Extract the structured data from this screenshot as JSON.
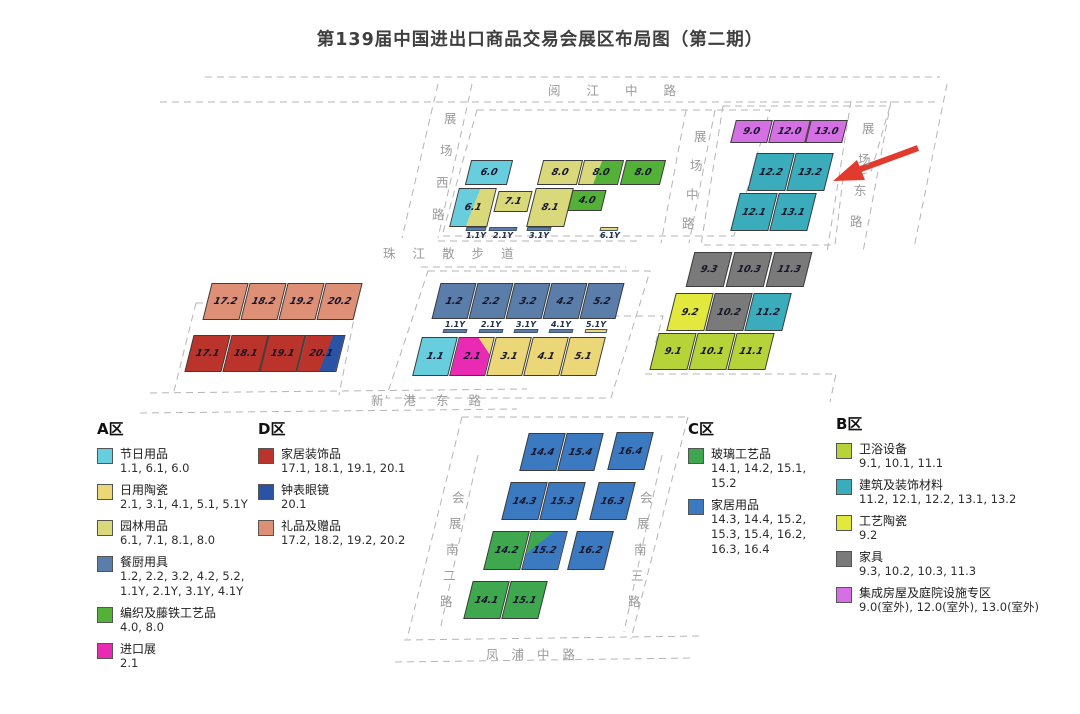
{
  "title": "第139届中国进出口商品交易会展区布局图（第二期）",
  "colors": {
    "festival": "#68cedd",
    "ceramics": "#ecd778",
    "garden": "#d9d97b",
    "kitchen": "#5a7ea9",
    "weave": "#53b137",
    "import": "#e92bb4",
    "homedeco": "#bb342b",
    "watch": "#2a52a5",
    "gifts": "#de9077",
    "glass": "#3fa84e",
    "household": "#3b7ac0",
    "bath": "#b6d43a",
    "building": "#3aacbb",
    "craftceramic": "#e3e83d",
    "furniture": "#7a7a7a",
    "outdoor": "#d470e4",
    "arrow": "#e23b2e",
    "dash": "#b5b5b5"
  },
  "map": {
    "halls": [
      {
        "label": "6.0",
        "color": "festival",
        "x": 468,
        "y": 160,
        "w": 42,
        "h": 25
      },
      {
        "label": "8.0",
        "color": "garden",
        "x": 540,
        "y": 160,
        "w": 40,
        "h": 25
      },
      {
        "label": "8.0",
        "split": {
          "dir": "v",
          "c1": "garden",
          "c2": "weave",
          "pct": 42
        },
        "x": 581,
        "y": 160,
        "w": 40,
        "h": 25
      },
      {
        "label": "8.0",
        "color": "weave",
        "x": 623,
        "y": 160,
        "w": 40,
        "h": 25
      },
      {
        "label": "6.1",
        "split": {
          "dir": "v",
          "c1": "festival",
          "c2": "garden",
          "pct": 50
        },
        "x": 454,
        "y": 188,
        "w": 38,
        "h": 39
      },
      {
        "label": "7.1",
        "color": "garden",
        "x": 496,
        "y": 191,
        "w": 34,
        "h": 21
      },
      {
        "label": "8.1",
        "color": "garden",
        "x": 531,
        "y": 188,
        "w": 38,
        "h": 39
      },
      {
        "label": "4.0",
        "color": "weave",
        "x": 570,
        "y": 190,
        "w": 34,
        "h": 21
      },
      {
        "label": "9.0",
        "color": "outdoor",
        "x": 733,
        "y": 120,
        "w": 37,
        "h": 23
      },
      {
        "label": "12.0",
        "color": "outdoor",
        "x": 771,
        "y": 120,
        "w": 37,
        "h": 23
      },
      {
        "label": "13.0",
        "color": "outdoor",
        "x": 808,
        "y": 120,
        "w": 37,
        "h": 23
      },
      {
        "label": "12.2",
        "color": "building",
        "x": 752,
        "y": 153,
        "w": 38,
        "h": 38
      },
      {
        "label": "13.2",
        "color": "building",
        "x": 791,
        "y": 153,
        "w": 38,
        "h": 38
      },
      {
        "label": "12.1",
        "color": "building",
        "x": 735,
        "y": 193,
        "w": 38,
        "h": 38
      },
      {
        "label": "13.1",
        "color": "building",
        "x": 774,
        "y": 193,
        "w": 38,
        "h": 38
      },
      {
        "label": "9.3",
        "color": "furniture",
        "x": 690,
        "y": 252,
        "w": 38,
        "h": 35
      },
      {
        "label": "10.3",
        "color": "furniture",
        "x": 730,
        "y": 252,
        "w": 38,
        "h": 35
      },
      {
        "label": "11.3",
        "color": "furniture",
        "x": 770,
        "y": 252,
        "w": 38,
        "h": 35
      },
      {
        "label": "9.2",
        "color": "craftceramic",
        "x": 671,
        "y": 293,
        "w": 38,
        "h": 38
      },
      {
        "label": "10.2",
        "color": "furniture",
        "x": 710,
        "y": 293,
        "w": 38,
        "h": 38
      },
      {
        "label": "11.2",
        "color": "building",
        "x": 749,
        "y": 293,
        "w": 38,
        "h": 38
      },
      {
        "label": "9.1",
        "color": "bath",
        "x": 654,
        "y": 333,
        "w": 38,
        "h": 37
      },
      {
        "label": "10.1",
        "color": "bath",
        "x": 693,
        "y": 333,
        "w": 38,
        "h": 37
      },
      {
        "label": "11.1",
        "color": "bath",
        "x": 732,
        "y": 333,
        "w": 38,
        "h": 37
      },
      {
        "label": "17.2",
        "color": "gifts",
        "x": 207,
        "y": 283,
        "w": 37,
        "h": 37
      },
      {
        "label": "18.2",
        "color": "gifts",
        "x": 245,
        "y": 283,
        "w": 37,
        "h": 37
      },
      {
        "label": "19.2",
        "color": "gifts",
        "x": 283,
        "y": 283,
        "w": 37,
        "h": 37
      },
      {
        "label": "20.2",
        "color": "gifts",
        "x": 321,
        "y": 283,
        "w": 37,
        "h": 37
      },
      {
        "label": "17.1",
        "color": "homedeco",
        "x": 189,
        "y": 335,
        "w": 37,
        "h": 37
      },
      {
        "label": "18.1",
        "color": "homedeco",
        "x": 227,
        "y": 335,
        "w": 37,
        "h": 37
      },
      {
        "label": "19.1",
        "color": "homedeco",
        "x": 264,
        "y": 335,
        "w": 37,
        "h": 37
      },
      {
        "label": "20.1",
        "split": {
          "dir": "v",
          "c1": "homedeco",
          "c2": "watch",
          "pct": 62
        },
        "x": 301,
        "y": 335,
        "w": 40,
        "h": 37
      },
      {
        "label": "1.2",
        "color": "kitchen",
        "x": 436,
        "y": 283,
        "w": 36,
        "h": 36
      },
      {
        "label": "2.2",
        "color": "kitchen",
        "x": 473,
        "y": 283,
        "w": 36,
        "h": 36
      },
      {
        "label": "3.2",
        "color": "kitchen",
        "x": 510,
        "y": 283,
        "w": 36,
        "h": 36
      },
      {
        "label": "4.2",
        "color": "kitchen",
        "x": 547,
        "y": 283,
        "w": 36,
        "h": 36
      },
      {
        "label": "5.2",
        "color": "kitchen",
        "x": 584,
        "y": 283,
        "w": 36,
        "h": 36
      },
      {
        "label": "1.1",
        "color": "festival",
        "x": 417,
        "y": 337,
        "w": 36,
        "h": 39
      },
      {
        "label": "2.1",
        "split": {
          "dir": "tr",
          "c1": "ceramics",
          "c2": "import",
          "pct": 22
        },
        "x": 454,
        "y": 337,
        "w": 36,
        "h": 39
      },
      {
        "label": "3.1",
        "color": "ceramics",
        "x": 491,
        "y": 337,
        "w": 36,
        "h": 39
      },
      {
        "label": "4.1",
        "color": "ceramics",
        "x": 528,
        "y": 337,
        "w": 36,
        "h": 39
      },
      {
        "label": "5.1",
        "color": "ceramics",
        "x": 565,
        "y": 337,
        "w": 36,
        "h": 39
      },
      {
        "label": "14.4",
        "color": "household",
        "x": 524,
        "y": 433,
        "w": 37,
        "h": 38
      },
      {
        "label": "15.4",
        "color": "household",
        "x": 562,
        "y": 433,
        "w": 37,
        "h": 38
      },
      {
        "label": "16.4",
        "color": "household",
        "x": 612,
        "y": 432,
        "w": 37,
        "h": 38
      },
      {
        "label": "14.3",
        "color": "household",
        "x": 506,
        "y": 482,
        "w": 37,
        "h": 38
      },
      {
        "label": "15.3",
        "color": "household",
        "x": 544,
        "y": 482,
        "w": 37,
        "h": 38
      },
      {
        "label": "16.3",
        "color": "household",
        "x": 594,
        "y": 482,
        "w": 37,
        "h": 38
      },
      {
        "label": "14.2",
        "color": "glass",
        "x": 488,
        "y": 531,
        "w": 37,
        "h": 39
      },
      {
        "label": "15.2",
        "split": {
          "dir": "tl",
          "c1": "glass",
          "c2": "household",
          "pct": 30
        },
        "x": 526,
        "y": 531,
        "w": 37,
        "h": 39
      },
      {
        "label": "16.2",
        "color": "household",
        "x": 572,
        "y": 531,
        "w": 37,
        "h": 39
      },
      {
        "label": "14.1",
        "color": "glass",
        "x": 468,
        "y": 581,
        "w": 37,
        "h": 38
      },
      {
        "label": "15.1",
        "color": "glass",
        "x": 506,
        "y": 581,
        "w": 37,
        "h": 38
      }
    ],
    "ybars": [
      {
        "label": "1.1Y",
        "color": "kitchen",
        "x": 466,
        "y": 227,
        "w": 20,
        "pos": "below"
      },
      {
        "label": "2.1Y",
        "color": "kitchen",
        "x": 489,
        "y": 227,
        "w": 28,
        "pos": "below"
      },
      {
        "label": "3.1Y",
        "color": "kitchen",
        "x": 527,
        "y": 227,
        "w": 24,
        "pos": "below"
      },
      {
        "label": "6.1Y",
        "color": "ceramics",
        "x": 600,
        "y": 227,
        "w": 18,
        "pos": "below"
      },
      {
        "label": "1.1Y",
        "color": "kitchen",
        "x": 443,
        "y": 330,
        "w": 24,
        "pos": "above"
      },
      {
        "label": "2.1Y",
        "color": "kitchen",
        "x": 479,
        "y": 330,
        "w": 24,
        "pos": "above"
      },
      {
        "label": "3.1Y",
        "color": "kitchen",
        "x": 514,
        "y": 330,
        "w": 24,
        "pos": "above"
      },
      {
        "label": "4.1Y",
        "color": "kitchen",
        "x": 549,
        "y": 330,
        "w": 24,
        "pos": "above"
      },
      {
        "label": "5.1Y",
        "color": "ceramics",
        "x": 585,
        "y": 330,
        "w": 22,
        "pos": "above"
      }
    ],
    "roads": [
      {
        "label": "阅江中路",
        "type": "h",
        "x": 548,
        "y": 80,
        "spacing": 26
      },
      {
        "label": "珠江散步道",
        "type": "h",
        "x": 383,
        "y": 243,
        "spacing": 17
      },
      {
        "label": "新港东路",
        "type": "h",
        "x": 371,
        "y": 390,
        "spacing": 20
      },
      {
        "label": "凤浦中路",
        "type": "h",
        "x": 486,
        "y": 644,
        "spacing": 13
      },
      {
        "label": "展场西路",
        "type": "v",
        "x": 444,
        "y": 108,
        "step": 32,
        "lean": 4
      },
      {
        "label": "展场中路",
        "type": "v",
        "x": 694,
        "y": 126,
        "step": 29,
        "lean": 4
      },
      {
        "label": "展场东路",
        "type": "v",
        "x": 862,
        "y": 118,
        "step": 31,
        "lean": 4
      },
      {
        "label": "会展南二路",
        "type": "v",
        "x": 452,
        "y": 487,
        "step": 26,
        "lean": 3
      },
      {
        "label": "会展南三路",
        "type": "v",
        "x": 640,
        "y": 487,
        "step": 26,
        "lean": 3
      }
    ]
  },
  "legend": {
    "zones": [
      {
        "title": "A区",
        "x": 97,
        "y": 418,
        "w": 158,
        "items": [
          {
            "color": "festival",
            "name": "节日用品",
            "nums": "1.1, 6.1, 6.0"
          },
          {
            "color": "ceramics",
            "name": "日用陶瓷",
            "nums": "2.1, 3.1, 4.1, 5.1, 5.1Y"
          },
          {
            "color": "garden",
            "name": "园林用品",
            "nums": "6.1, 7.1, 8.1, 8.0"
          },
          {
            "color": "kitchen",
            "name": "餐厨用具",
            "nums": "1.2, 2.2, 3.2, 4.2, 5.2, 1.1Y, 2.1Y, 3.1Y, 4.1Y"
          },
          {
            "color": "weave",
            "name": "编织及藤铁工艺品",
            "nums": "4.0, 8.0"
          },
          {
            "color": "import",
            "name": "进口展",
            "nums": "2.1"
          }
        ]
      },
      {
        "title": "D区",
        "x": 258,
        "y": 418,
        "w": 165,
        "items": [
          {
            "color": "homedeco",
            "name": "家居装饰品",
            "nums": "17.1, 18.1, 19.1, 20.1"
          },
          {
            "color": "watch",
            "name": "钟表眼镜",
            "nums": "20.1"
          },
          {
            "color": "gifts",
            "name": "礼品及赠品",
            "nums": "17.2, 18.2, 19.2, 20.2"
          }
        ]
      },
      {
        "title": "C区",
        "x": 688,
        "y": 418,
        "w": 140,
        "items": [
          {
            "color": "glass",
            "name": "玻璃工艺品",
            "nums": "14.1, 14.2, 15.1, 15.2"
          },
          {
            "color": "household",
            "name": "家居用品",
            "nums": "14.3, 14.4, 15.2, 15.3, 15.4, 16.2, 16.3, 16.4"
          }
        ]
      },
      {
        "title": "B区",
        "x": 836,
        "y": 413,
        "w": 238,
        "items": [
          {
            "color": "bath",
            "name": "卫浴设备",
            "nums": "9.1, 10.1, 11.1"
          },
          {
            "color": "building",
            "name": "建筑及装饰材料",
            "nums": "11.2, 12.1, 12.2, 13.1, 13.2"
          },
          {
            "color": "craftceramic",
            "name": "工艺陶瓷",
            "nums": "9.2"
          },
          {
            "color": "furniture",
            "name": "家具",
            "nums": "9.3, 10.2, 10.3, 11.3"
          },
          {
            "color": "outdoor",
            "name": "集成房屋及庭院设施专区",
            "nums": "9.0(室外), 12.0(室外), 13.0(室外)"
          }
        ]
      }
    ]
  }
}
